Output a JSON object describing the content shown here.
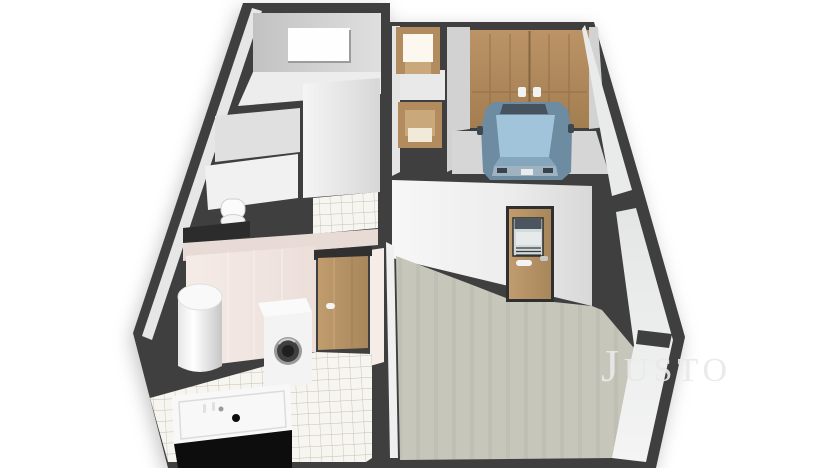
{
  "scene": {
    "kind": "3d-floor-plan-render",
    "view": "isometric-top",
    "rooms": [
      {
        "name": "bedroom-top-left",
        "features": [
          "window-in-back-wall"
        ]
      },
      {
        "name": "hallway",
        "features": [
          "small-door-north",
          "small-door-interior"
        ]
      },
      {
        "name": "garage",
        "features": [
          "double-wood-garage-door",
          "blue-car"
        ]
      },
      {
        "name": "living-room",
        "features": [
          "glazed-door-to-garage",
          "beige-floor"
        ]
      },
      {
        "name": "closet-wc",
        "features": [
          "toilet"
        ]
      },
      {
        "name": "bathroom",
        "features": [
          "water-heater-cylinder",
          "washing-machine",
          "bathtub",
          "wood-door",
          "white-tile-floor"
        ]
      }
    ]
  },
  "watermark": {
    "lead": "J",
    "rest": "USTO"
  },
  "colors": {
    "wall_dark": "#3f3f3f",
    "black": "#0d0d0d",
    "face_light": "#e6e6e6",
    "face_mid": "#d2d2d2",
    "floor_room": "#ededed",
    "floor_hall": "#e9e9e9",
    "floor_garage": "#d6d6d6",
    "floor_main": "#c6c6ba",
    "tile_bg": "#f7f5f0",
    "tile_line": "#b8b5ac",
    "pink_face": "#f2e8e4",
    "pink_top": "#e8dbd6",
    "wood": "#b28c5e",
    "wood_light": "#c9a97c",
    "wood_dark": "#8a6a46",
    "door_glow": "#fdf8ef",
    "car_glass": "#a2c4da",
    "car_body": "#6d8ba1",
    "car_roof": "#46525e",
    "car_hood": "#86a6be",
    "car_bumper": "#9fb2c0",
    "fixture_white": "#f8f8f8",
    "watermark_gray": "#e9e9e9"
  }
}
